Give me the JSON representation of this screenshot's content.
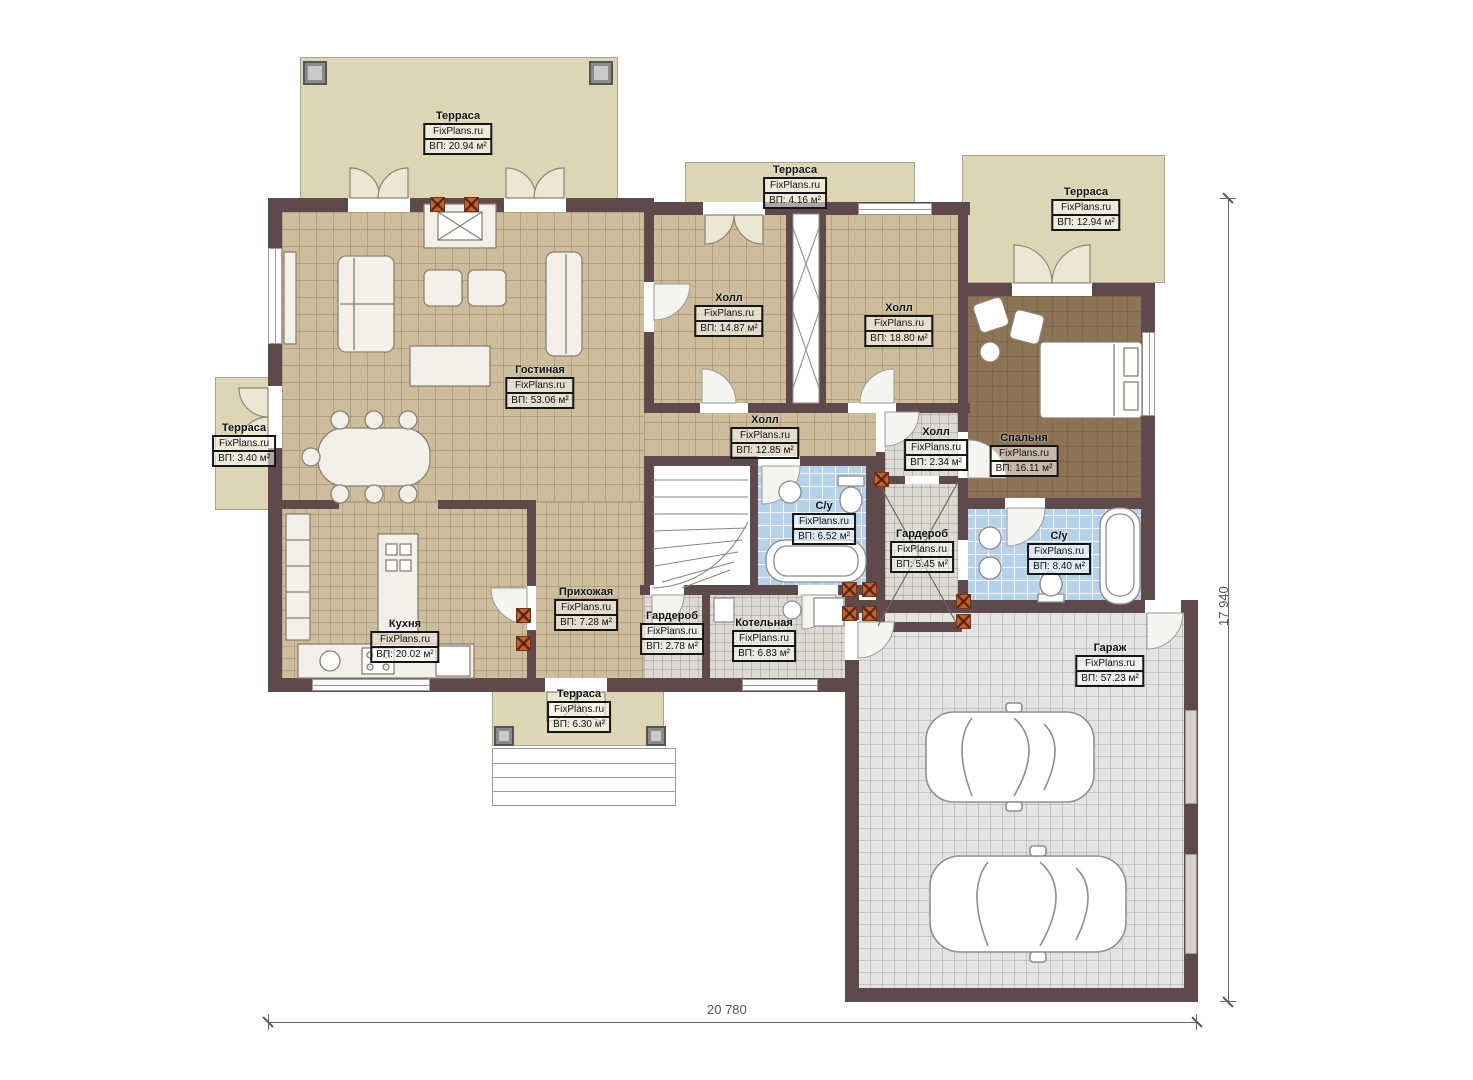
{
  "meta": {
    "brand": "FixPlans.ru",
    "plan_type": "Первый этаж / floor plan"
  },
  "dimensions": {
    "bottom": "20 780",
    "right": "17 940"
  },
  "rooms": [
    {
      "id": "terrace-top-left",
      "name": "Терраса",
      "area": "ВП: 20.94 м²"
    },
    {
      "id": "terrace-top-middle",
      "name": "Терраса",
      "area": "ВП: 4.16 м²"
    },
    {
      "id": "terrace-top-right",
      "name": "Терраса",
      "area": "ВП: 12.94 м²"
    },
    {
      "id": "terrace-left",
      "name": "Терраса",
      "area": "ВП: 3.40 м²"
    },
    {
      "id": "living-room",
      "name": "Гостиная",
      "area": "ВП: 53.06 м²"
    },
    {
      "id": "hall-top-left",
      "name": "Холл",
      "area": "ВП: 14.87 м²"
    },
    {
      "id": "hall-top-right",
      "name": "Холл",
      "area": "ВП: 18.80 м²"
    },
    {
      "id": "bedroom",
      "name": "Спальня",
      "area": "ВП: 16.11 м²"
    },
    {
      "id": "hall-middle",
      "name": "Холл",
      "area": "ВП: 12.85 м²"
    },
    {
      "id": "hall-small",
      "name": "Холл",
      "area": "ВП: 2.34 м²"
    },
    {
      "id": "bathroom-1",
      "name": "С/у",
      "area": "ВП: 6.52 м²"
    },
    {
      "id": "wardrobe-1",
      "name": "Гардероб",
      "area": "ВП: 5.45 м²"
    },
    {
      "id": "bathroom-2",
      "name": "С/у",
      "area": "ВП: 8.40 м²"
    },
    {
      "id": "kitchen",
      "name": "Кухня",
      "area": "ВП: 20.02 м²"
    },
    {
      "id": "entrance-hall",
      "name": "Прихожая",
      "area": "ВП: 7.28 м²"
    },
    {
      "id": "wardrobe-2",
      "name": "Гардероб",
      "area": "ВП: 2.78 м²"
    },
    {
      "id": "boiler-room",
      "name": "Котельная",
      "area": "ВП: 6.83 м²"
    },
    {
      "id": "garage",
      "name": "Гараж",
      "area": "ВП: 57.23 м²"
    },
    {
      "id": "terrace-bottom",
      "name": "Терраса",
      "area": "ВП: 6.30 м²"
    }
  ],
  "colors": {
    "wall": "#5e4a4a",
    "terrace": "#ddd6b5",
    "tile_tan": "#ccbe9d",
    "tile_blue": "#b5d2ea",
    "tile_gray": "#dcdad2",
    "floor_bedroom": "#8c7355",
    "brick_column": "#c4622f",
    "dimension_text": "#555555"
  }
}
